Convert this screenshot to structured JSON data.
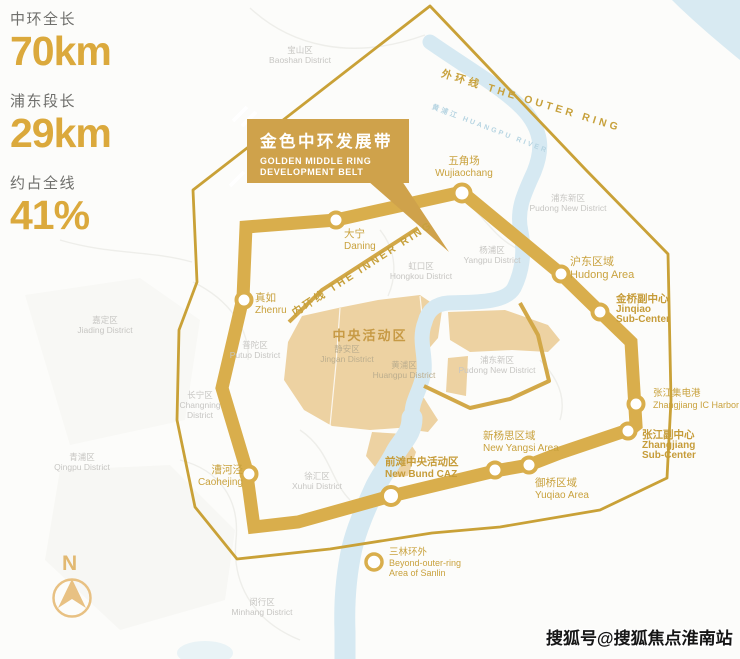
{
  "stats": [
    {
      "label": "中环全长",
      "value": "70km"
    },
    {
      "label": "浦东段长",
      "value": "29km"
    },
    {
      "label": "约占全线",
      "value": "41%"
    }
  ],
  "banner": {
    "title": "金色中环发展带",
    "subtitle1": "GOLDEN MIDDLE RING",
    "subtitle2": "DEVELOPMENT BELT"
  },
  "ring_labels": {
    "outer": "外环线  THE OUTER RING",
    "inner": "内环线  THE INNER RING",
    "river": "黄浦江  HUANGPU RIVER"
  },
  "caz": {
    "label": "中央活动区"
  },
  "nodes": {
    "wujiaochang": {
      "zh": "五角场",
      "en": "Wujiaochang"
    },
    "daning": {
      "zh": "大宁",
      "en": "Daning"
    },
    "zhenru": {
      "zh": "真如",
      "en": "Zhenru"
    },
    "hudong": {
      "zh": "沪东区域",
      "en": "Hudong Area"
    },
    "jinqiao": {
      "zh": "金桥副中心",
      "en1": "Jinqiao",
      "en2": "Sub-Center"
    },
    "zhangjiang_ic": {
      "zh": "张江集电港",
      "en": "Zhangjiang IC Harbor"
    },
    "zhangjiang_sub": {
      "zh": "张江副中心",
      "en1": "Zhangjiang",
      "en2": "Sub-Center"
    },
    "new_yangsi": {
      "zh": "新杨思区域",
      "en": "New Yangsi Area"
    },
    "yuqiao": {
      "zh": "御桥区域",
      "en": "Yuqiao Area"
    },
    "new_bund": {
      "zh": "前滩中央活动区",
      "en": "New Bund CAZ"
    },
    "caohejing": {
      "zh": "漕河泾",
      "en": "Caohejing"
    },
    "sanlin": {
      "zh": "三林环外",
      "en1": "Beyond-outer-ring",
      "en2": "Area of Sanlin"
    }
  },
  "districts": {
    "baoshan": {
      "zh": "宝山区",
      "en": "Baoshan District"
    },
    "jiading": {
      "zh": "嘉定区",
      "en": "Jiading District"
    },
    "qingpu": {
      "zh": "青浦区",
      "en": "Qingpu District"
    },
    "changning": {
      "zh": "长宁区",
      "en1": "Changning",
      "en2": "District"
    },
    "putuo": {
      "zh": "普陀区",
      "en": "Putuo District"
    },
    "jingan": {
      "zh": "静安区",
      "en": "Jingan District"
    },
    "hongkou": {
      "zh": "虹口区",
      "en": "Hongkou District"
    },
    "yangpu": {
      "zh": "杨浦区",
      "en": "Yangpu District"
    },
    "huangpu": {
      "zh": "黄浦区",
      "en": "Huangpu District"
    },
    "pudong_north": {
      "zh": "浦东新区",
      "en": "Pudong New District"
    },
    "pudong_mid": {
      "zh": "浦东新区",
      "en": "Pudong New District"
    },
    "xuhui": {
      "zh": "徐汇区",
      "en": "Xuhui District"
    },
    "minhang": {
      "zh": "闵行区",
      "en": "Minhang District"
    }
  },
  "compass": {
    "label": "N"
  },
  "watermark": {
    "text": "搜狐号@搜狐焦点淮南站"
  },
  "colors": {
    "middle_ring_gold": "#D9AE4C",
    "outer_ring_gold": "#C9A137",
    "inner_ring_gold": "#D2A848",
    "label_gold": "#C9A23E",
    "banner_gold": "#CFA24B",
    "stat_gold": "#DBA93C",
    "caz_tan": "#EDD2A2",
    "river_blue": "#D6E9F2"
  }
}
